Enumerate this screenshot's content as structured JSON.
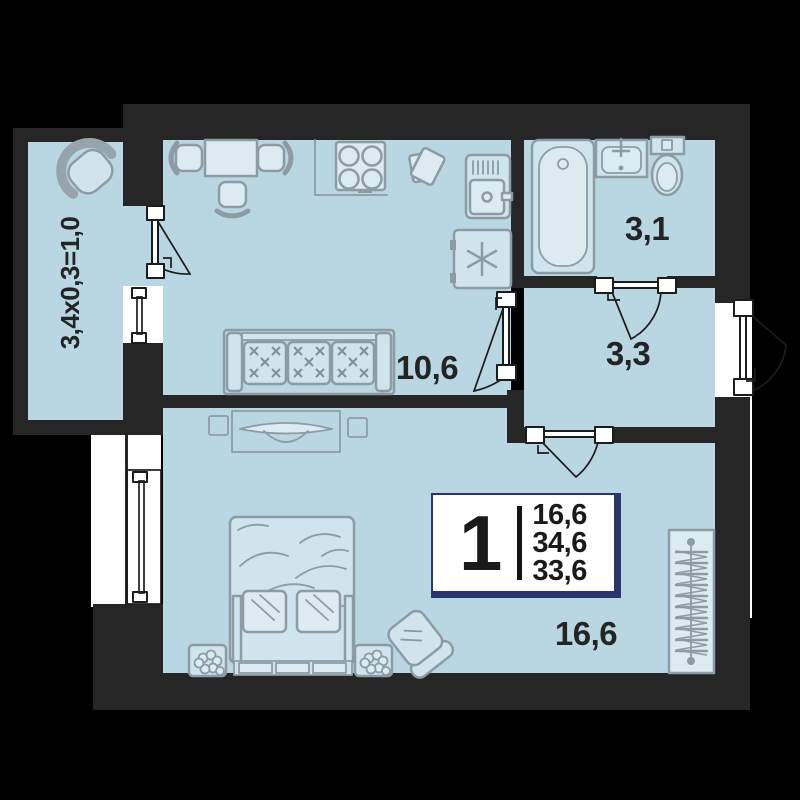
{
  "rooms": {
    "balcony_label": "3,4х0,3=1,0",
    "kitchen_living_label": "10,6",
    "bathroom_label": "3,1",
    "hallway_label": "3,3",
    "bedroom_label": "16,6"
  },
  "badge": {
    "rooms_count": "1",
    "areas": [
      "16,6",
      "34,6",
      "33,6"
    ]
  },
  "colors": {
    "background": "#000000",
    "wall": "#262626",
    "room_fill": "#b9d7e2",
    "furniture_fill": "#cfe4ec",
    "furniture_line": "#8d9ca4",
    "badge_border": "#2b3569",
    "exterior_white": "#ffffff",
    "text": "#242424"
  }
}
